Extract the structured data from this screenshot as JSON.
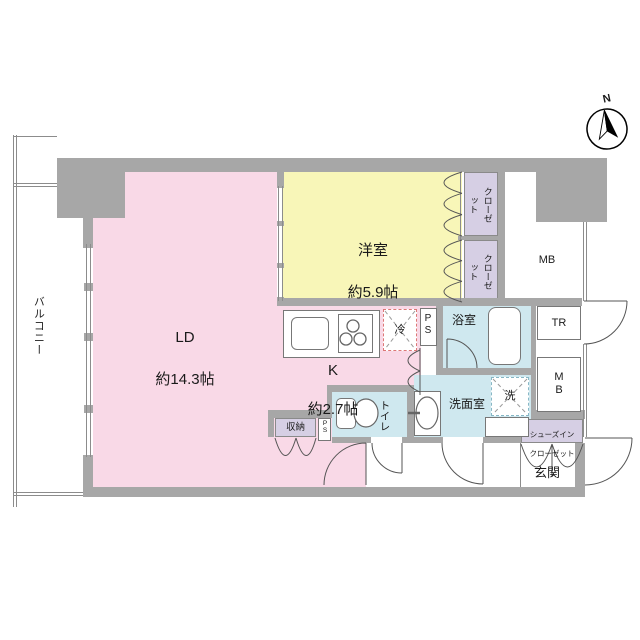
{
  "compass": {
    "north_label": "N"
  },
  "balcony": {
    "label": "バルコニー"
  },
  "rooms": {
    "ld": {
      "name": "LD",
      "size": "約14.3帖"
    },
    "western": {
      "name": "洋室",
      "size": "約5.9帖"
    },
    "kitchen": {
      "name": "K",
      "size": "約2.7帖"
    },
    "closet_top": {
      "label": "クローゼット"
    },
    "closet_bottom": {
      "label": "クローゼット"
    },
    "meter_box_top": {
      "label": "MB"
    },
    "trunk_room": {
      "label": "TR"
    },
    "meter_box_right": {
      "label": "MB"
    },
    "bathroom": {
      "label": "浴室"
    },
    "washroom": {
      "label": "洗面室"
    },
    "washer": {
      "label": "洗"
    },
    "fridge": {
      "label": "冷"
    },
    "pipe_shaft_top": {
      "label": "PS"
    },
    "pipe_shaft_small": {
      "label": "PS"
    },
    "toilet": {
      "label": "トイレ"
    },
    "storage": {
      "label": "収納"
    },
    "shoes_closet": {
      "line1": "シューズイン",
      "line2": "クローゼット"
    },
    "entrance": {
      "label": "玄関"
    }
  },
  "colors": {
    "wall_gray": "#a7a7a7",
    "ld_pink": "#f9d9e7",
    "room_yellow": "#f8f6b8",
    "wet_blue": "#cfe8ef",
    "closet_purple": "#d6cfe4",
    "fridge_dash_red": "#dd7777",
    "washer_dash_teal": "#88b7c5"
  }
}
